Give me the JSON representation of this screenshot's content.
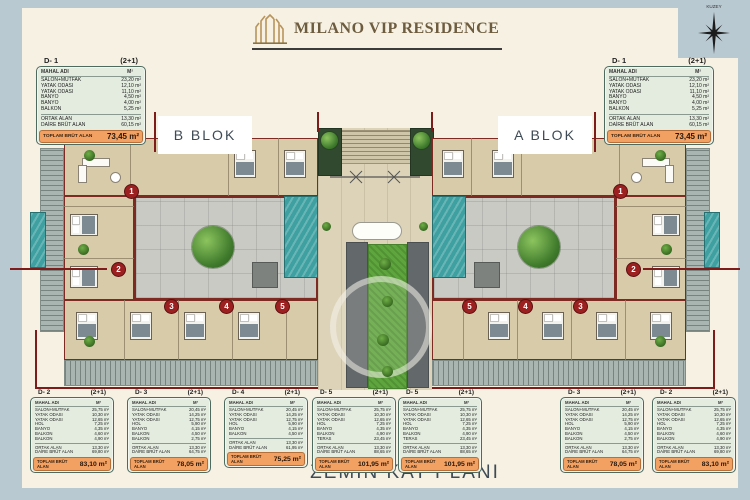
{
  "header": {
    "title": "MILANO VIP RESIDENCE"
  },
  "compass": {
    "label": "KUZEY"
  },
  "floor_title": "ZEMİN KAT PLANI",
  "blocks": {
    "left": "B BLOK",
    "right": "A BLOK"
  },
  "table_columns": {
    "name": "MAHAL ADI",
    "area": "M²"
  },
  "totals_label": "TOPLAM BRÜT ALAN",
  "unit_types": {
    "d1": {
      "code": "D- 1",
      "scheme": "(2+1)",
      "rooms": [
        {
          "label": "SALON+MUTFAK",
          "area": "23,20 m²"
        },
        {
          "label": "YATAK ODASI",
          "area": "12,10 m²"
        },
        {
          "label": "YATAK ODASI",
          "area": "11,10 m²"
        },
        {
          "label": "BANYO",
          "area": "4,50 m²"
        },
        {
          "label": "BANYO",
          "area": "4,00 m²"
        },
        {
          "label": "BALKON",
          "area": "5,25 m²"
        }
      ],
      "common": [
        {
          "label": "ORTAK ALAN",
          "area": "13,30 m²"
        },
        {
          "label": "DAİRE BRÜT ALAN",
          "area": "60,15 m²"
        }
      ],
      "total": "73,45 m²"
    },
    "d2": {
      "code": "D- 2",
      "scheme": "(2+1)",
      "rooms": [
        {
          "label": "SALON+MUTFAK",
          "area": "25,75 m²"
        },
        {
          "label": "YATAK ODASI",
          "area": "10,30 m²"
        },
        {
          "label": "YATAK ODASI",
          "area": "12,65 m²"
        },
        {
          "label": "HOL",
          "area": "7,25 m²"
        },
        {
          "label": "BANYO",
          "area": "4,35 m²"
        },
        {
          "label": "BALKON",
          "area": "4,60 m²"
        },
        {
          "label": "BALKON",
          "area": "4,90 m²"
        }
      ],
      "common": [
        {
          "label": "ORTAK ALAN",
          "area": "13,30 m²"
        },
        {
          "label": "DAİRE BRÜT ALAN",
          "area": "69,80 m²"
        }
      ],
      "total": "83,10 m²"
    },
    "d3": {
      "code": "D- 3",
      "scheme": "(2+1)",
      "rooms": [
        {
          "label": "SALON+MUTFAK",
          "area": "20,45 m²"
        },
        {
          "label": "YATAK ODASI",
          "area": "14,25 m²"
        },
        {
          "label": "YATAK ODASI",
          "area": "12,75 m²"
        },
        {
          "label": "HOL",
          "area": "5,90 m²"
        },
        {
          "label": "BANYO",
          "area": "4,15 m²"
        },
        {
          "label": "BALKON",
          "area": "4,50 m²"
        },
        {
          "label": "BALKON",
          "area": "2,75 m²"
        }
      ],
      "common": [
        {
          "label": "ORTAK ALAN",
          "area": "13,30 m²"
        },
        {
          "label": "DAİRE BRÜT ALAN",
          "area": "64,75 m²"
        }
      ],
      "total": "78,05 m²"
    },
    "d4": {
      "code": "D- 4",
      "scheme": "(2+1)",
      "rooms": [
        {
          "label": "SALON+MUTFAK",
          "area": "20,45 m²"
        },
        {
          "label": "YATAK ODASI",
          "area": "14,25 m²"
        },
        {
          "label": "YATAK ODASI",
          "area": "12,75 m²"
        },
        {
          "label": "HOL",
          "area": "5,90 m²"
        },
        {
          "label": "BANYO",
          "area": "4,15 m²"
        },
        {
          "label": "BALKON",
          "area": "4,50 m²"
        }
      ],
      "common": [
        {
          "label": "ORTAK ALAN",
          "area": "13,30 m²"
        },
        {
          "label": "DAİRE BRÜT ALAN",
          "area": "61,95 m²"
        }
      ],
      "total": "75,25 m²"
    },
    "d5": {
      "code": "D- 5",
      "scheme": "(2+1)",
      "rooms": [
        {
          "label": "SALON+MUTFAK",
          "area": "25,75 m²"
        },
        {
          "label": "YATAK ODASI",
          "area": "10,30 m²"
        },
        {
          "label": "YATAK ODASI",
          "area": "12,65 m²"
        },
        {
          "label": "HOL",
          "area": "7,25 m²"
        },
        {
          "label": "BANYO",
          "area": "4,35 m²"
        },
        {
          "label": "BALKON",
          "area": "4,90 m²"
        },
        {
          "label": "TERAS",
          "area": "23,45 m²"
        }
      ],
      "common": [
        {
          "label": "ORTAK ALAN",
          "area": "13,30 m²"
        },
        {
          "label": "DAİRE BRÜT ALAN",
          "area": "88,65 m²"
        }
      ],
      "total": "101,95 m²"
    }
  },
  "placed_tables": {
    "top": [
      "d1",
      "d1"
    ],
    "bottom": [
      "d2",
      "d3",
      "d4",
      "d5",
      "d5",
      "d3",
      "d2"
    ]
  },
  "unit_markers": {
    "left": [
      "1",
      "2",
      "3",
      "4",
      "5"
    ],
    "right": [
      "1",
      "2",
      "3",
      "4",
      "5"
    ]
  },
  "colors": {
    "frame": "#b9c9d1",
    "page": "#f6f1e3",
    "gold": "#b9945a",
    "slate": "#3e4a55",
    "table_green": "#e3ecdf",
    "total_orange": "#f2a163",
    "section_red": "#7e1c1c",
    "pool_teal": "#3fa0a2",
    "lawn_green": "#5fa53d"
  }
}
